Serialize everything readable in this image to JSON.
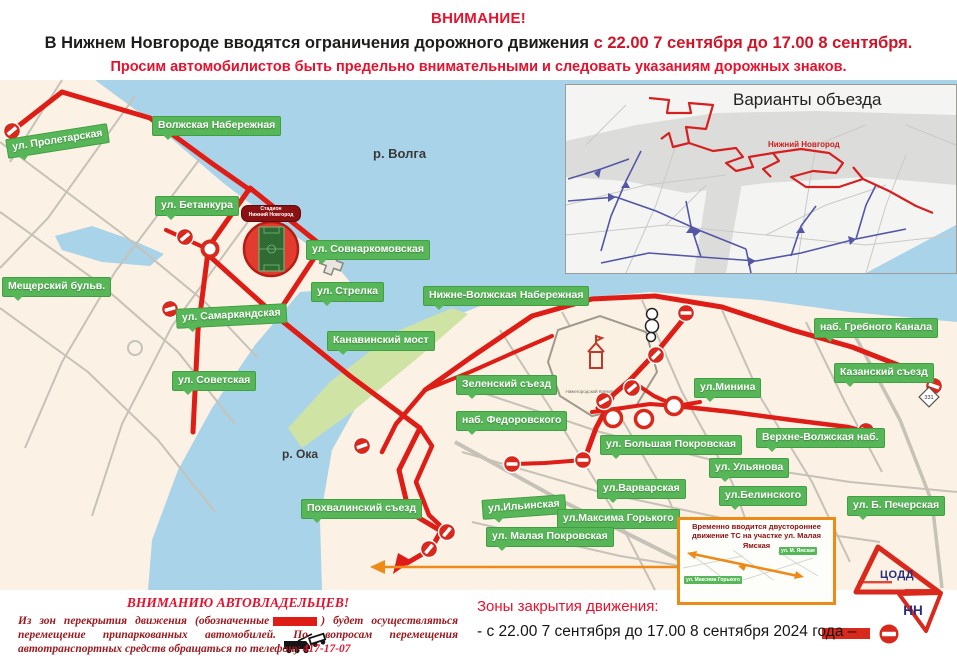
{
  "header": {
    "title": "ВНИМАНИЕ!",
    "subtitle_black": "В Нижнем Новгороде вводятся ограничения дорожного движения",
    "subtitle_red": " с 22.00 7 сентября до 17.00 8 сентября.",
    "line3": "Просим автомобилистов быть предельно внимательными и следовать указаниям дорожных знаков."
  },
  "map": {
    "river_labels": {
      "volga": "р. Волга",
      "oka": "р. Ока"
    },
    "street_labels": [
      {
        "label": "ул. Пролетарская",
        "x": 6,
        "y": 131,
        "rot": -9
      },
      {
        "label": "Волжская Набережная",
        "x": 152,
        "y": 116,
        "rot": 0
      },
      {
        "label": "ул. Бетанкура",
        "x": 155,
        "y": 196,
        "rot": 0
      },
      {
        "label": "ул. Совнаркомовская",
        "x": 306,
        "y": 240,
        "rot": 0
      },
      {
        "label": "Мещерский бульв.",
        "x": 2,
        "y": 277,
        "rot": 0
      },
      {
        "label": "ул. Стрелка",
        "x": 311,
        "y": 282,
        "rot": 0
      },
      {
        "label": "Нижне-Волжская Набережная",
        "x": 423,
        "y": 286,
        "rot": 0
      },
      {
        "label": "ул. Самаркандская",
        "x": 176,
        "y": 306,
        "rot": -3
      },
      {
        "label": "Канавинский мост",
        "x": 327,
        "y": 331,
        "rot": 0
      },
      {
        "label": "наб. Гребного Канала",
        "x": 814,
        "y": 318,
        "rot": 0
      },
      {
        "label": "ул. Советская",
        "x": 172,
        "y": 371,
        "rot": 0
      },
      {
        "label": "Зеленский съезд",
        "x": 456,
        "y": 375,
        "rot": 0
      },
      {
        "label": "ул.Минина",
        "x": 694,
        "y": 378,
        "rot": 0
      },
      {
        "label": "Казанский съезд",
        "x": 834,
        "y": 363,
        "rot": 0
      },
      {
        "label": "наб. Федоровского",
        "x": 456,
        "y": 411,
        "rot": 0
      },
      {
        "label": "ул. Большая Покровская",
        "x": 600,
        "y": 435,
        "rot": 0
      },
      {
        "label": "Верхне-Волжская наб.",
        "x": 756,
        "y": 428,
        "rot": 0
      },
      {
        "label": "ул. Ульянова",
        "x": 709,
        "y": 458,
        "rot": 0
      },
      {
        "label": "ул.Варварская",
        "x": 597,
        "y": 479,
        "rot": 0
      },
      {
        "label": "ул.Белинского",
        "x": 719,
        "y": 486,
        "rot": 0
      },
      {
        "label": "Похвалинский съезд",
        "x": 301,
        "y": 499,
        "rot": 0
      },
      {
        "label": "ул.Ильинская",
        "x": 482,
        "y": 497,
        "rot": -4
      },
      {
        "label": "ул.Максима Горького",
        "x": 557,
        "y": 509,
        "rot": 0
      },
      {
        "label": "ул. Б. Печерская",
        "x": 847,
        "y": 496,
        "rot": 0
      },
      {
        "label": "ул. Малая Покровская",
        "x": 486,
        "y": 527,
        "rot": 0
      }
    ],
    "stadium": {
      "line1": "Стадион",
      "line2": "Нижний Новгород"
    },
    "kremlin_label": "Нижегородский Кремль",
    "road_sign": "331"
  },
  "inset": {
    "title": "Варианты объезда",
    "city_label": "Нижний Новгород"
  },
  "notice_box": {
    "text": "Временно вводится двустороннее движение ТС на участке ул. Малая Ямская",
    "mini_labels": [
      "ул. М. Ямская",
      "ул. Максима Горького"
    ]
  },
  "owners_notice": {
    "title": "ВНИМАНИЮ АВТОВЛАДЕЛЬЦЕВ!",
    "body_before": "Из зон перекрытия движения (обозначенные",
    "body_after": ") будет осуществляться перемещение припаркованных автомобилей. По вопросам перемещения автотранспортных средств обращаться по телефону",
    "phone": "417-17-07"
  },
  "legend": {
    "title": "Зоны закрытия движения:",
    "item_text": "- с 22.00 7 сентября до 17.00 8 сентября 2024 года –"
  },
  "logo": {
    "line1": "ЦОДД",
    "line2": "НН"
  },
  "colors": {
    "closure_red": "#dd1d16",
    "label_green": "#57b657",
    "water_blue": "#a9d3e8",
    "accent_red": "#e8112d",
    "orange": "#ee8a18"
  }
}
